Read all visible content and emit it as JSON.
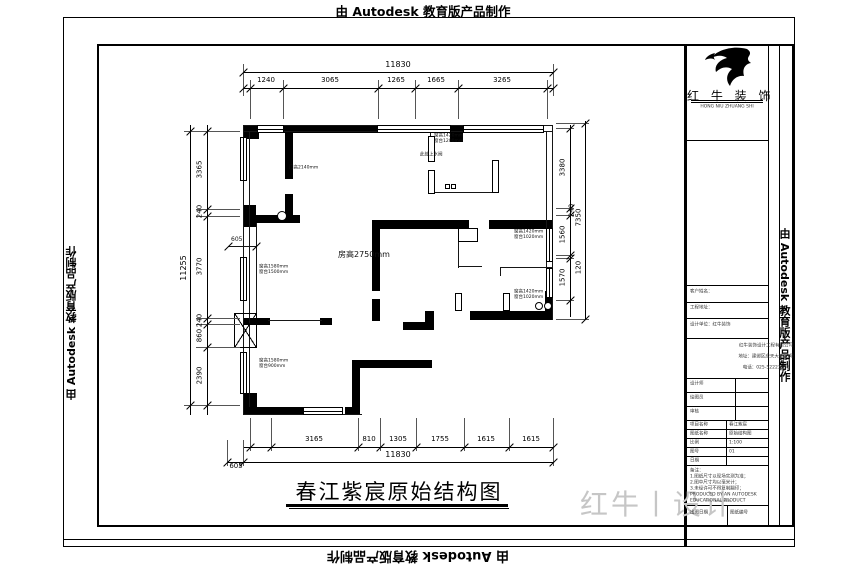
{
  "watermarks": {
    "top": "由 Autodesk 教育版产品制作",
    "bottom": "由 Autodesk 教育版产品制作",
    "left": "由 Autodesk 教育版产品制作",
    "right": "由 Autodesk 教育版产品制作"
  },
  "title": {
    "text": "春江紫宸原始结构图"
  },
  "brand": {
    "name": "红 牛 装 饰",
    "caption": "HONG NIU ZHUANG SHI",
    "design_watermark": "红牛丨设计"
  },
  "plan": {
    "room_height_label": "房高2750mm",
    "rects": [
      [
        "k",
        243,
        125,
        16,
        14
      ],
      [
        "k",
        283,
        125,
        94,
        8
      ],
      [
        "k",
        450,
        125,
        13,
        17
      ],
      [
        "k",
        243,
        205,
        13,
        22
      ],
      [
        "k",
        285,
        133,
        8,
        46
      ],
      [
        "k",
        285,
        194,
        8,
        28
      ],
      [
        "k",
        243,
        215,
        57,
        8
      ],
      [
        "k",
        372,
        220,
        97,
        9
      ],
      [
        "k",
        489,
        220,
        64,
        9
      ],
      [
        "k",
        372,
        229,
        8,
        62
      ],
      [
        "k",
        372,
        299,
        8,
        22
      ],
      [
        "k",
        545,
        291,
        8,
        29
      ],
      [
        "k",
        470,
        311,
        83,
        9
      ],
      [
        "k",
        425,
        311,
        9,
        19
      ],
      [
        "k",
        403,
        322,
        31,
        8
      ],
      [
        "k",
        352,
        360,
        80,
        8
      ],
      [
        "k",
        352,
        368,
        8,
        47
      ],
      [
        "k",
        243,
        407,
        62,
        8
      ],
      [
        "k",
        345,
        407,
        15,
        8
      ],
      [
        "k",
        243,
        393,
        14,
        22
      ],
      [
        "k",
        243,
        318,
        27,
        7
      ],
      [
        "k",
        320,
        318,
        12,
        7
      ],
      [
        "l",
        243,
        125,
        310,
        1
      ],
      [
        "l",
        243,
        131,
        310,
        1
      ],
      [
        "l",
        243,
        125,
        1,
        290
      ],
      [
        "l",
        249,
        131,
        1,
        276
      ],
      [
        "l",
        552,
        125,
        1,
        195
      ],
      [
        "l",
        546,
        131,
        1,
        160
      ],
      [
        "l",
        243,
        414,
        119,
        1
      ],
      [
        "l",
        430,
        131,
        1,
        30
      ],
      [
        "l",
        430,
        170,
        1,
        23
      ],
      [
        "l",
        430,
        192,
        65,
        1
      ],
      [
        "l",
        495,
        161,
        1,
        31
      ],
      [
        "l",
        256,
        223,
        1,
        90
      ],
      [
        "l",
        268,
        320,
        54,
        1
      ],
      [
        "l",
        458,
        242,
        1,
        26
      ],
      [
        "l",
        458,
        266,
        24,
        1
      ],
      [
        "l",
        500,
        267,
        53,
        1
      ],
      [
        "l",
        500,
        267,
        1,
        9
      ],
      [
        "l",
        228,
        246,
        28,
        1
      ],
      [
        "o",
        428,
        136,
        7,
        26
      ],
      [
        "o",
        428,
        170,
        7,
        24
      ],
      [
        "o",
        492,
        160,
        7,
        33
      ],
      [
        "o",
        458,
        228,
        20,
        14
      ],
      [
        "o",
        455,
        293,
        7,
        18
      ],
      [
        "o",
        503,
        293,
        7,
        18
      ],
      [
        "o",
        445,
        184,
        5,
        5
      ],
      [
        "o",
        451,
        184,
        5,
        5
      ],
      [
        "wv",
        240,
        137,
        7,
        44
      ],
      [
        "wv",
        240,
        257,
        7,
        44
      ],
      [
        "wv",
        240,
        352,
        7,
        42
      ],
      [
        "wh",
        257,
        125,
        27,
        8
      ],
      [
        "wv",
        546,
        228,
        7,
        34
      ],
      [
        "wv",
        546,
        268,
        7,
        30
      ],
      [
        "wh",
        303,
        407,
        40,
        8
      ],
      [
        "wh",
        377,
        125,
        74,
        8
      ],
      [
        "wh",
        463,
        125,
        81,
        8
      ],
      [
        "x",
        234,
        313,
        23,
        35
      ],
      [
        "c",
        277,
        211,
        10,
        10
      ],
      [
        "c",
        535,
        302,
        8,
        8
      ],
      [
        "c",
        544,
        302,
        8,
        8
      ]
    ],
    "labels": [
      {
        "x": 289,
        "y": 165,
        "l": [
          "门高2140mm"
        ]
      },
      {
        "x": 434,
        "y": 133,
        "l": [
          "窗高1420mm",
          "窗台1200mm"
        ]
      },
      {
        "x": 420,
        "y": 152,
        "l": [
          "此处上水阀"
        ]
      },
      {
        "x": 514,
        "y": 229,
        "l": [
          "窗高1420mm",
          "窗台1020mm"
        ]
      },
      {
        "x": 514,
        "y": 289,
        "l": [
          "窗高1420mm",
          "窗台1020mm"
        ]
      },
      {
        "x": 259,
        "y": 264,
        "l": [
          "窗高1580mm",
          "窗台1500mm"
        ]
      },
      {
        "x": 259,
        "y": 358,
        "l": [
          "窗高1580mm",
          "窗台900mm"
        ]
      },
      {
        "x": 338,
        "y": 249,
        "l": [
          "房高2750mm"
        ],
        "s": 8
      },
      {
        "x": 231,
        "y": 236,
        "l": [
          "605"
        ],
        "s": 6
      }
    ]
  },
  "dims": {
    "lines": [
      [
        243,
        72,
        310,
        1
      ],
      [
        243,
        88,
        310,
        1
      ],
      [
        190,
        125,
        1,
        290
      ],
      [
        207,
        125,
        1,
        290
      ],
      [
        570,
        125,
        1,
        192
      ],
      [
        585,
        121,
        1,
        198
      ],
      [
        243,
        447,
        310,
        1
      ],
      [
        227,
        462,
        326,
        1
      ]
    ],
    "ticks": [
      [
        243,
        72
      ],
      [
        553,
        72
      ],
      [
        243,
        88
      ],
      [
        250,
        88
      ],
      [
        283,
        88
      ],
      [
        378,
        88
      ],
      [
        415,
        88
      ],
      [
        458,
        88
      ],
      [
        547,
        88
      ],
      [
        553,
        88
      ],
      [
        190,
        131
      ],
      [
        190,
        405
      ],
      [
        207,
        131
      ],
      [
        207,
        209
      ],
      [
        207,
        216
      ],
      [
        207,
        318
      ],
      [
        207,
        324
      ],
      [
        207,
        347
      ],
      [
        207,
        405
      ],
      [
        570,
        128
      ],
      [
        570,
        208
      ],
      [
        570,
        215
      ],
      [
        570,
        255
      ],
      [
        570,
        258
      ],
      [
        570,
        300
      ],
      [
        585,
        123
      ],
      [
        585,
        319
      ],
      [
        250,
        447
      ],
      [
        271,
        447
      ],
      [
        358,
        447
      ],
      [
        380,
        447
      ],
      [
        416,
        447
      ],
      [
        464,
        447
      ],
      [
        509,
        447
      ],
      [
        553,
        447
      ],
      [
        227,
        462
      ],
      [
        243,
        462
      ],
      [
        553,
        462
      ],
      [
        228,
        246
      ],
      [
        256,
        246
      ]
    ],
    "ext": [
      [
        243,
        64,
        1,
        32
      ],
      [
        553,
        64,
        1,
        32
      ],
      [
        250,
        80,
        1,
        39
      ],
      [
        283,
        80,
        1,
        39
      ],
      [
        378,
        80,
        1,
        39
      ],
      [
        415,
        80,
        1,
        39
      ],
      [
        458,
        80,
        1,
        39
      ],
      [
        547,
        80,
        1,
        39
      ],
      [
        196,
        131,
        44,
        1
      ],
      [
        196,
        209,
        44,
        1
      ],
      [
        196,
        216,
        44,
        1
      ],
      [
        196,
        318,
        44,
        1
      ],
      [
        196,
        324,
        44,
        1
      ],
      [
        196,
        347,
        44,
        1
      ],
      [
        196,
        405,
        44,
        1
      ],
      [
        184,
        131,
        12,
        1
      ],
      [
        184,
        405,
        12,
        1
      ],
      [
        556,
        128,
        18,
        1
      ],
      [
        556,
        208,
        18,
        1
      ],
      [
        556,
        215,
        18,
        1
      ],
      [
        556,
        255,
        18,
        1
      ],
      [
        556,
        258,
        18,
        1
      ],
      [
        556,
        300,
        18,
        1
      ],
      [
        556,
        123,
        33,
        1
      ],
      [
        556,
        319,
        33,
        1
      ],
      [
        250,
        418,
        1,
        33
      ],
      [
        271,
        418,
        1,
        33
      ],
      [
        358,
        418,
        1,
        33
      ],
      [
        380,
        418,
        1,
        33
      ],
      [
        416,
        418,
        1,
        33
      ],
      [
        464,
        418,
        1,
        33
      ],
      [
        509,
        418,
        1,
        33
      ],
      [
        227,
        440,
        1,
        26
      ],
      [
        243,
        440,
        1,
        26
      ],
      [
        553,
        418,
        1,
        48
      ]
    ],
    "labels": [
      {
        "x": 398,
        "y": 65,
        "t": "11830",
        "b": 1
      },
      {
        "x": 266,
        "y": 81,
        "t": "1240"
      },
      {
        "x": 330,
        "y": 81,
        "t": "3065"
      },
      {
        "x": 396,
        "y": 81,
        "t": "1265"
      },
      {
        "x": 436,
        "y": 81,
        "t": "1665"
      },
      {
        "x": 502,
        "y": 81,
        "t": "3265"
      },
      {
        "x": 184,
        "y": 268,
        "t": "11255",
        "r": 1,
        "b": 1
      },
      {
        "x": 200,
        "y": 170,
        "t": "3365",
        "r": 1
      },
      {
        "x": 200,
        "y": 212,
        "t": "240",
        "r": 1
      },
      {
        "x": 200,
        "y": 267,
        "t": "3770",
        "r": 1
      },
      {
        "x": 200,
        "y": 321,
        "t": "240",
        "r": 1
      },
      {
        "x": 200,
        "y": 336,
        "t": "860",
        "r": 1
      },
      {
        "x": 200,
        "y": 376,
        "t": "2390",
        "r": 1
      },
      {
        "x": 563,
        "y": 168,
        "t": "3380",
        "r": 1
      },
      {
        "x": 563,
        "y": 235,
        "t": "1560",
        "r": 1
      },
      {
        "x": 563,
        "y": 278,
        "t": "1570",
        "r": 1
      },
      {
        "x": 572,
        "y": 211,
        "t": "240",
        "r": 1
      },
      {
        "x": 579,
        "y": 218,
        "t": "7350",
        "r": 1
      },
      {
        "x": 579,
        "y": 268,
        "t": "120",
        "r": 1
      },
      {
        "x": 314,
        "y": 440,
        "t": "3165"
      },
      {
        "x": 369,
        "y": 440,
        "t": "810"
      },
      {
        "x": 398,
        "y": 440,
        "t": "1305"
      },
      {
        "x": 440,
        "y": 440,
        "t": "1755"
      },
      {
        "x": 486,
        "y": 440,
        "t": "1615"
      },
      {
        "x": 531,
        "y": 440,
        "t": "1615"
      },
      {
        "x": 398,
        "y": 455,
        "t": "11830",
        "b": 1
      },
      {
        "x": 236,
        "y": 467,
        "t": "605"
      }
    ]
  },
  "frame": {
    "lines": [
      [
        63,
        17,
        732,
        1
      ],
      [
        63,
        546,
        732,
        1
      ],
      [
        63,
        17,
        1,
        530
      ],
      [
        794,
        17,
        1,
        530
      ],
      [
        63,
        539,
        732,
        1
      ],
      [
        97,
        44,
        697,
        2
      ],
      [
        97,
        525,
        697,
        2
      ],
      [
        97,
        44,
        2,
        483
      ],
      [
        792,
        44,
        2,
        481
      ],
      [
        684,
        44,
        3,
        502
      ],
      [
        768,
        44,
        1,
        481
      ],
      [
        779,
        44,
        1,
        481
      ],
      [
        691,
        100,
        72,
        1
      ],
      [
        691,
        102,
        72,
        1
      ],
      [
        687,
        140,
        81,
        1
      ],
      [
        687,
        285,
        81,
        1
      ],
      [
        687,
        302,
        81,
        1
      ],
      [
        687,
        318,
        81,
        1
      ],
      [
        687,
        338,
        81,
        1
      ],
      [
        687,
        378,
        81,
        1
      ],
      [
        687,
        392,
        81,
        1
      ],
      [
        687,
        406,
        81,
        1
      ],
      [
        687,
        420,
        81,
        1
      ],
      [
        687,
        429,
        81,
        1
      ],
      [
        687,
        438,
        81,
        1
      ],
      [
        687,
        447,
        81,
        1
      ],
      [
        687,
        456,
        81,
        1
      ],
      [
        687,
        465,
        81,
        1
      ],
      [
        687,
        505,
        81,
        1
      ],
      [
        735,
        378,
        1,
        42
      ],
      [
        726,
        420,
        1,
        45
      ],
      [
        727,
        505,
        1,
        20
      ],
      [
        286,
        504,
        222,
        3
      ],
      [
        289,
        508,
        220,
        1
      ]
    ]
  },
  "titleblock": {
    "rows_top": [
      "客户姓名：",
      "工程地址：",
      "设计单位：红牛装饰"
    ],
    "company": [
      "红牛装饰设计工程有限公司",
      "地址：建邺区应天大街98号",
      "电话：025-52223135"
    ],
    "grid": [
      [
        "设计师",
        ""
      ],
      [
        "绘图员",
        ""
      ],
      [
        "审核",
        ""
      ]
    ],
    "rows": [
      [
        "项目名称",
        "春江紫宸"
      ],
      [
        "图纸名称",
        "原始结构图"
      ],
      [
        "比例",
        "1:100"
      ],
      [
        "图号",
        "01"
      ],
      [
        "日期",
        ""
      ]
    ],
    "notes": [
      "备注：",
      "1.图纸尺寸以现场实测为准；",
      "2.图中尺寸均以毫米计；",
      "3.未经许可不得复制翻印；",
      "PRODUCED BY AN AUTODESK",
      "EDUCATIONAL PRODUCT"
    ],
    "bottom_cells": [
      "出图日期",
      "图纸编号"
    ]
  }
}
